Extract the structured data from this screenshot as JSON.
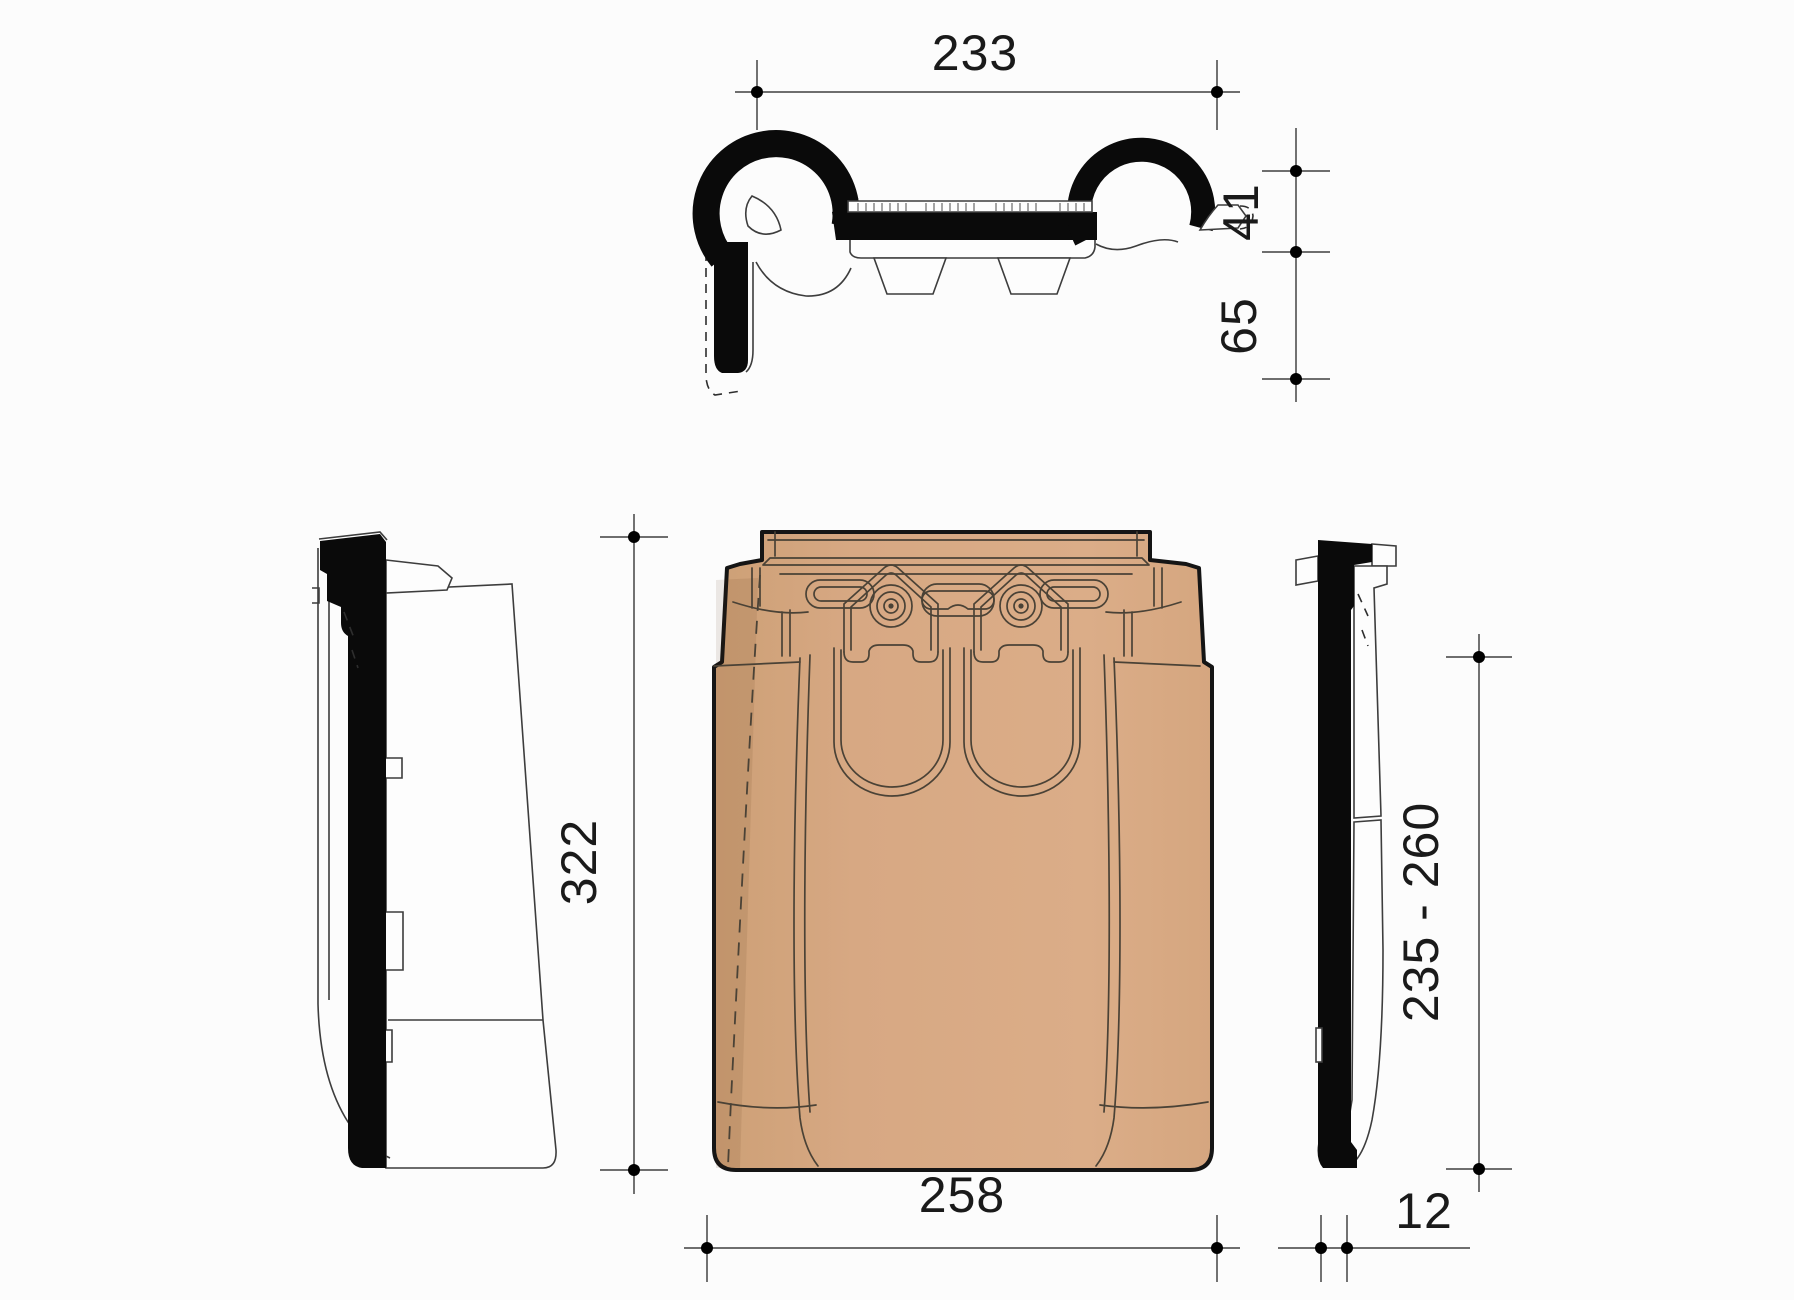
{
  "drawing": {
    "dimensions": {
      "top_width": "233",
      "roll_height": "41",
      "head_depth": "65",
      "tile_length": "322",
      "tile_width": "258",
      "edge_thickness": "12",
      "batten_range": "235 - 260"
    },
    "colors": {
      "tile_fill": "#D7A883",
      "tile_fill_shadow": "#C89B76",
      "tile_outline": "#4A4236",
      "silhouette": "#0A0A0A",
      "dimension_line": "#5A5A5A",
      "dimension_text": "#1A1A1A",
      "background": "#FCFCFC"
    }
  }
}
